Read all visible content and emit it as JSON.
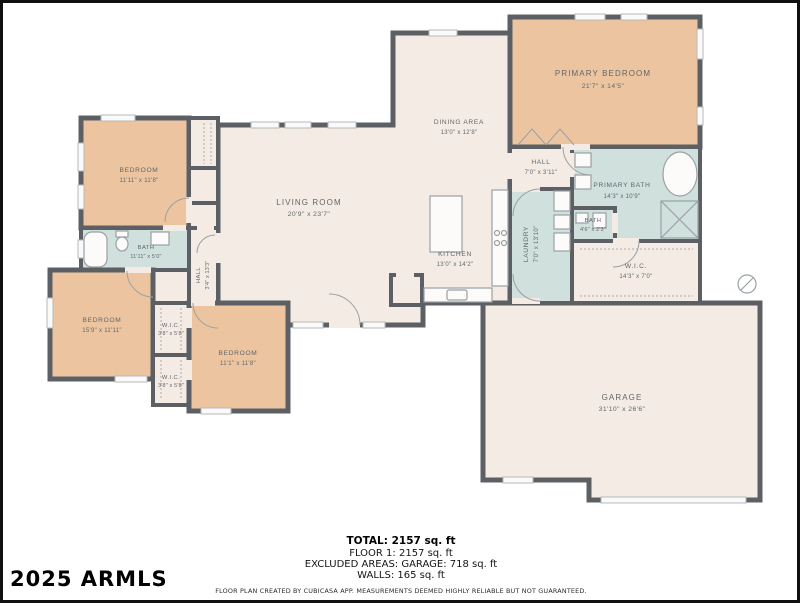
{
  "watermark": "2025 ARMLS",
  "colors": {
    "wall": "#5c6064",
    "bedroom_fill": "#ecc5a0",
    "bath_fill": "#cfe0dd",
    "floor_fill": "#f4ece4",
    "label_text": "#5f666b",
    "frame_border": "#101010"
  },
  "rooms": {
    "primary_bedroom": {
      "name": "PRIMARY BEDROOM",
      "dims": "21'7\" x 14'5\""
    },
    "hall_upper": {
      "name": "HALL",
      "dims": "7'0\" x 3'11\""
    },
    "primary_bath": {
      "name": "PRIMARY BATH",
      "dims": "14'3\" x 10'9\""
    },
    "bath_small": {
      "name": "BATH",
      "dims": "4'6\" x 2'3\""
    },
    "wic_primary": {
      "name": "W.I.C.",
      "dims": "14'3\" x 7'0\""
    },
    "laundry": {
      "name": "LAUNDRY",
      "dims": "7'0\" x 13'10\""
    },
    "kitchen": {
      "name": "KITCHEN",
      "dims": "13'0\" x 14'2\""
    },
    "dining": {
      "name": "DINING AREA",
      "dims": "13'0\" x 12'8\""
    },
    "living": {
      "name": "LIVING ROOM",
      "dims": "20'9\" x 23'7\""
    },
    "bedroom_nw": {
      "name": "BEDROOM",
      "dims": "11'11\" x 11'8\""
    },
    "bath_hall": {
      "name": "BATH",
      "dims": "11'11\" x 5'0\""
    },
    "hall_vertical": {
      "name": "HALL",
      "dims": "3'4\" x 13'3\""
    },
    "bedroom_sw": {
      "name": "BEDROOM",
      "dims": "15'9\" x 11'11\""
    },
    "wic_a": {
      "name": "W.I.C.",
      "dims": "3'8\" x 5'8\""
    },
    "wic_b": {
      "name": "W.I.C.",
      "dims": "3'8\" x 5'8\""
    },
    "bedroom_s": {
      "name": "BEDROOM",
      "dims": "11'1\" x 11'8\""
    },
    "garage": {
      "name": "GARAGE",
      "dims": "31'10\" x 26'6\""
    }
  },
  "summary": {
    "total": "TOTAL: 2157 sq. ft",
    "floor": "FLOOR 1: 2157 sq. ft",
    "excluded": "EXCLUDED AREAS: GARAGE: 718 sq. ft",
    "walls": "WALLS: 165 sq. ft"
  },
  "disclaimer": "FLOOR PLAN CREATED BY CUBICASA APP. MEASUREMENTS DEEMED HIGHLY RELIABLE BUT NOT GUARANTEED."
}
